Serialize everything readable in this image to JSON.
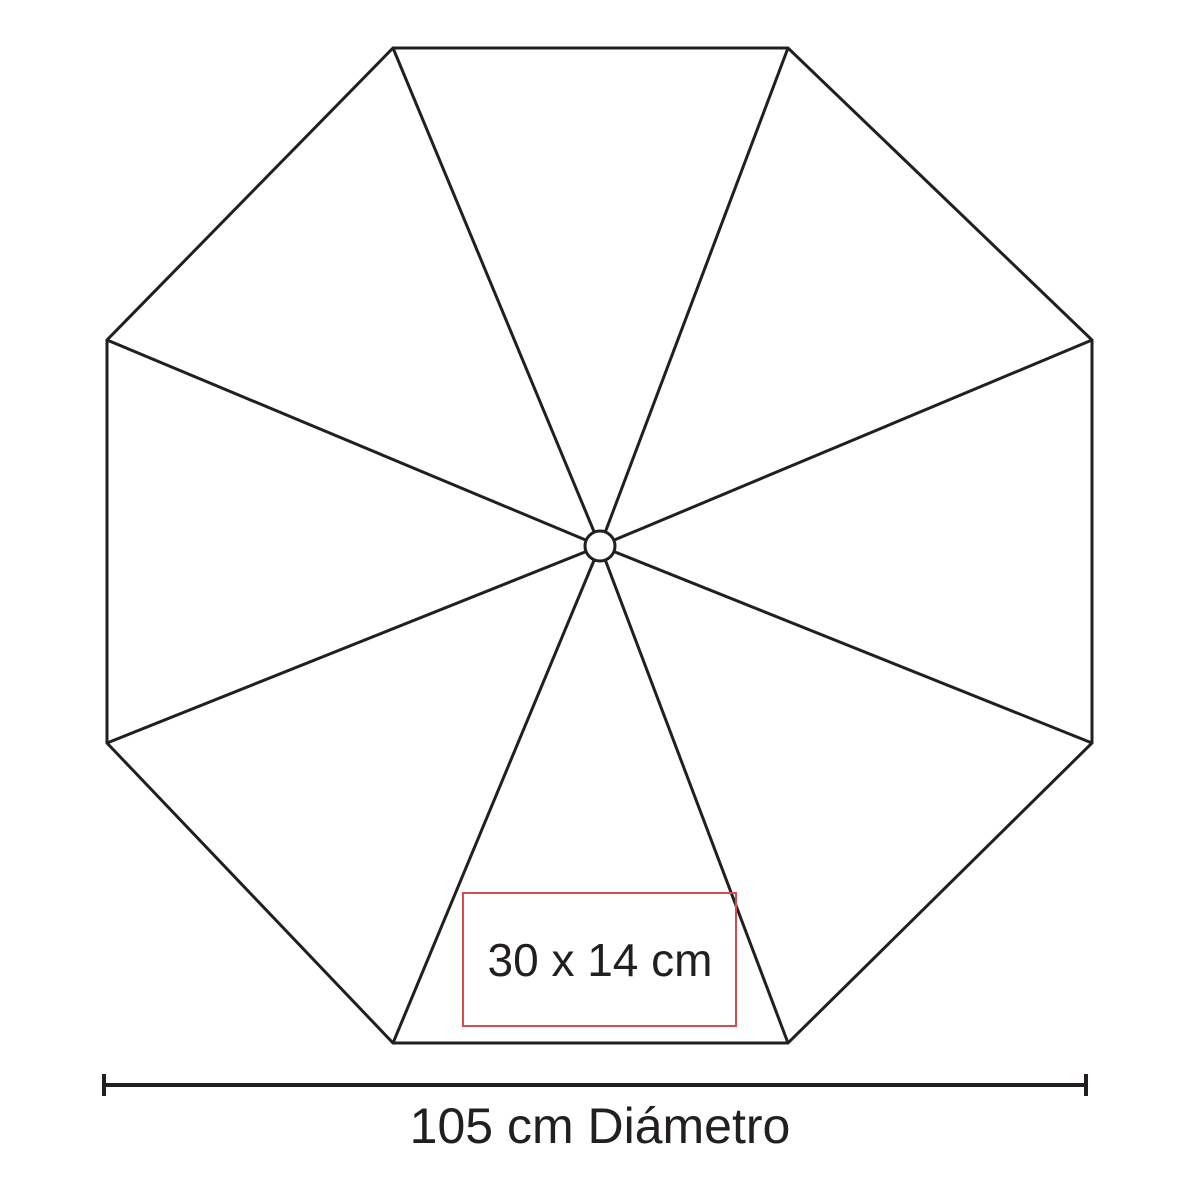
{
  "diagram": {
    "kind": "umbrella-top-view-dimension-diagram",
    "panels_count": 8,
    "imprint_area": {
      "label": "30 x 14 cm"
    },
    "dimension": {
      "label": "105 cm Diámetro"
    },
    "colors": {
      "background": "#ffffff",
      "outline": "#231f20",
      "text": "#231f20",
      "imprint_box": "#d94b4e"
    }
  }
}
